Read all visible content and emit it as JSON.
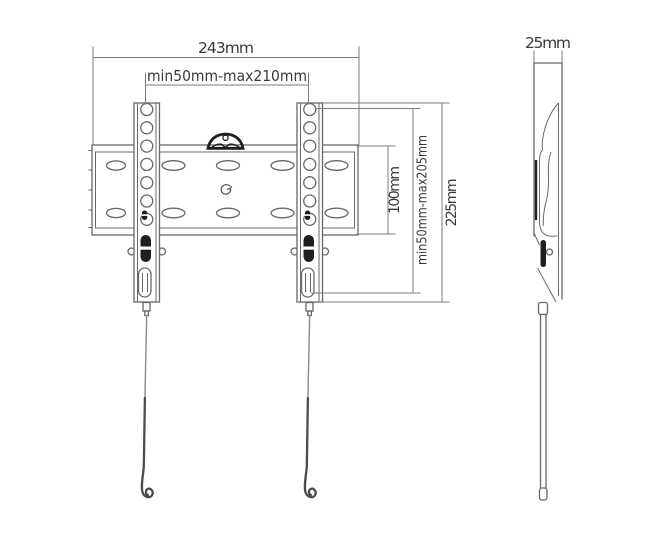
{
  "diagram": {
    "type": "technical-drawing",
    "subject": "Fixed TV wall mount bracket - front elevation and side elevation with dimensions",
    "front_view": {
      "overall_width": "243mm",
      "horizontal_mounting_range": "min50mm-max210mm",
      "plate_height": "100mm",
      "vertical_mounting_range": "min50mm-max205mm",
      "overall_height": "225mm"
    },
    "side_view": {
      "depth": "25mm"
    },
    "colors": {
      "background": "#ffffff",
      "line": "#686868",
      "dimension": "#7b7b7b",
      "dark_ink": "#1f1f1f",
      "text": "#3a3a3a",
      "string": "#4f4b4a"
    }
  }
}
